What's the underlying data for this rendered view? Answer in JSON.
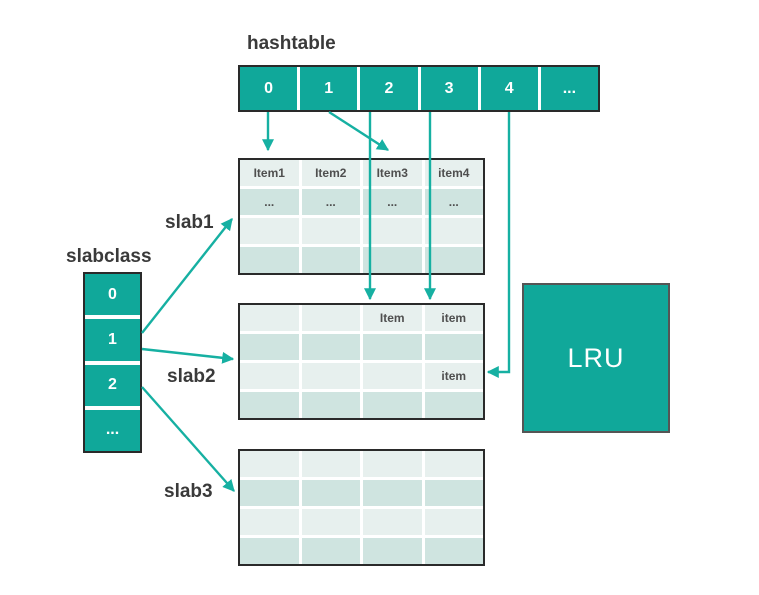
{
  "labels": {
    "hashtable": "hashtable",
    "slabclass": "slabclass",
    "slab1": "slab1",
    "slab2": "slab2",
    "slab3": "slab3",
    "lru": "LRU"
  },
  "hashtable": {
    "cells": [
      "0",
      "1",
      "2",
      "3",
      "4",
      "..."
    ]
  },
  "slabclass": {
    "cells": [
      "0",
      "1",
      "2",
      "..."
    ]
  },
  "slabs": [
    {
      "name": "slab1",
      "rows": [
        [
          "Item1",
          "Item2",
          "Item3",
          "item4"
        ],
        [
          "...",
          "...",
          "...",
          "..."
        ],
        [
          "",
          "",
          "",
          ""
        ],
        [
          "",
          "",
          "",
          ""
        ]
      ]
    },
    {
      "name": "slab2",
      "rows": [
        [
          "",
          "",
          "Item",
          "item"
        ],
        [
          "",
          "",
          "",
          ""
        ],
        [
          "",
          "",
          "",
          "item"
        ],
        [
          "",
          "",
          "",
          ""
        ]
      ]
    },
    {
      "name": "slab3",
      "rows": [
        [
          "",
          "",
          "",
          ""
        ],
        [
          "",
          "",
          "",
          ""
        ],
        [
          "",
          "",
          "",
          ""
        ],
        [
          "",
          "",
          "",
          ""
        ]
      ]
    }
  ],
  "lru": {
    "label": "LRU"
  },
  "colors": {
    "teal": "#10a89a",
    "arrow": "#16b0a2",
    "row_light": "#e7f0ee",
    "row_dark": "#cfe4e0",
    "border_dark": "#2a2a2a",
    "lru_border": "#555555",
    "text_dark": "#3a3a3a",
    "cell_text": "#4f4f4f"
  },
  "arrows": [
    {
      "name": "hashtable-0-to-slab1",
      "points": [
        [
          268,
          112
        ],
        [
          268,
          150
        ]
      ]
    },
    {
      "name": "hashtable-1-to-slab1",
      "points": [
        [
          329,
          112
        ],
        [
          388,
          150
        ]
      ]
    },
    {
      "name": "hashtable-2-to-slab2",
      "points": [
        [
          370,
          112
        ],
        [
          370,
          299
        ]
      ]
    },
    {
      "name": "hashtable-3-to-slab2",
      "points": [
        [
          430,
          112
        ],
        [
          430,
          299
        ]
      ]
    },
    {
      "name": "hashtable-4-to-slab2-item",
      "points": [
        [
          509,
          112
        ],
        [
          509,
          372
        ],
        [
          488,
          372
        ]
      ]
    },
    {
      "name": "slabclass-1-to-slab1",
      "points": [
        [
          142,
          333
        ],
        [
          232,
          219
        ]
      ]
    },
    {
      "name": "slabclass-1-to-slab2",
      "points": [
        [
          142,
          349
        ],
        [
          233,
          359
        ]
      ]
    },
    {
      "name": "slabclass-2-to-slab3",
      "points": [
        [
          142,
          387
        ],
        [
          234,
          491
        ]
      ]
    }
  ]
}
